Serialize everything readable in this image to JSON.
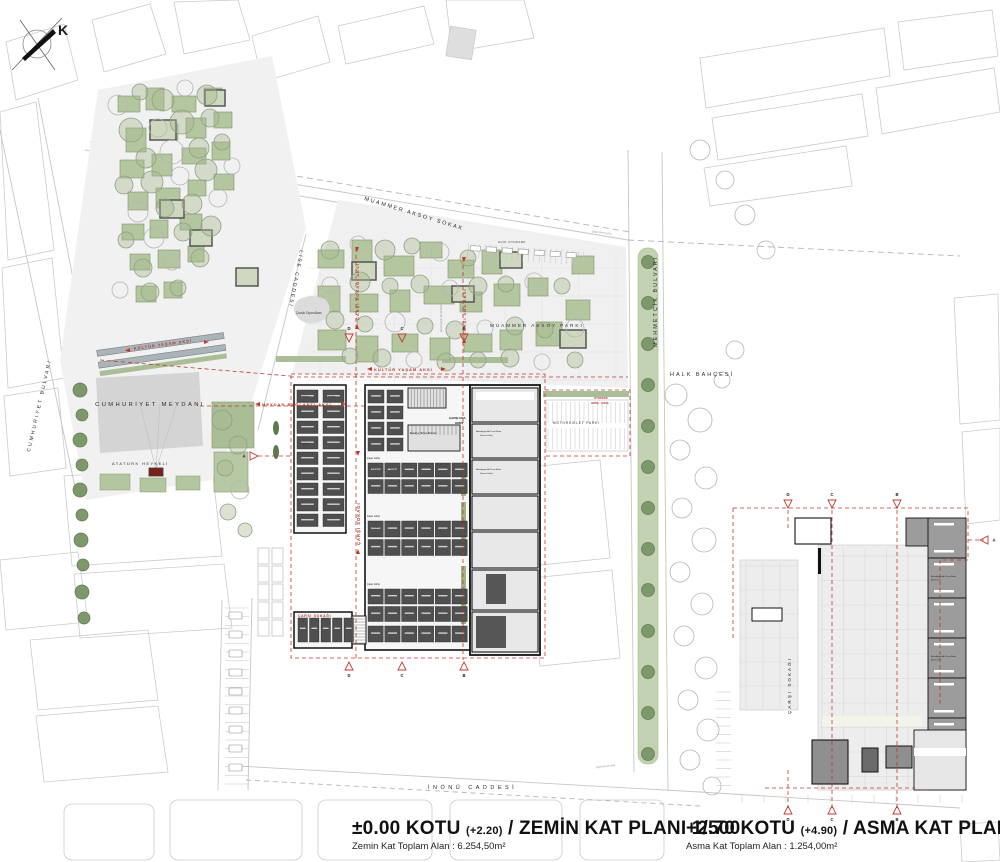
{
  "compass": {
    "letter": "K"
  },
  "streets": {
    "muammer_aksoy_sokak": "MUAMMER AKSOY SOKAK",
    "lise_caddesi": "LİSE CADDESİ",
    "cumhuriyet_bulvari": "CUMHURİYET BULVARI",
    "mehmetcik_bulvari": "MEHMETÇİK BULVARI",
    "inonu_caddesi": "İNÖNÜ CADDESİ"
  },
  "places": {
    "cumhuriyet_meydani": "CUMHURİYET MEYDANI",
    "ataturk_heykeli": "ATATÜRK HEYKELİ",
    "muammer_aksoy_parki": "MUAMMER AKSOY PARKI",
    "halk_bahcesi": "HALK BAHÇESİ",
    "motosiklet_parki": "MOTORSİKLET PARKI",
    "acik_otopark": "AÇIK OTOPARK",
    "cocuk_oyun_alani": "Çocuk Oyun Alanı",
    "gecici_acik_sergi_alani": "Geçici Açık Sergi Alanı",
    "yaya_cevre_yolu": "yaya çevre yolu",
    "carsi_sokagi_main": "ÇARŞI SOKAĞI",
    "carsi_sokagi_branch": "ÇARŞI SOKAĞI",
    "carsi_sokagi_right": "ÇARŞI SOKAĞI"
  },
  "axes": {
    "kultur_yasam_aksi": "KÜLTÜR YAŞAM AKSI",
    "meydan_baglanti_aksi": "MEYDAN BAĞLANTI AKSI",
    "carsi_sokagi_aksi": "ÇARŞI SOKAĞI AKSI",
    "carsi_ana_aksi": "ÇARŞI ANA AKSI"
  },
  "entrances": {
    "carsi_ana_giris_l1": "ÇARŞI ANA",
    "carsi_ana_giris_l2": "GİRİŞ",
    "otopark_giris_l1": "OTOPARK",
    "otopark_giris_l2": "GİRİŞ - ÇIKIŞ",
    "carsi_girisi": "Çarşı Girişi"
  },
  "units": {
    "dukkan": "Dükkan",
    "belediye_hizmet": "Belediye Hizmet Birimleri",
    "belediye_ticari_l1": "Belediyeye Ait Ticari Birim",
    "belediye_ticari_l2": "(Servis Kafe)",
    "belediye_ticari_asma_l1": "Belediyeye Ait Ticari Birim",
    "belediye_ticari_asma_l2": "Asma Kat"
  },
  "section_markers": {
    "a": "A",
    "b": "B",
    "c": "C",
    "d": "D"
  },
  "captions": {
    "zemin": {
      "kot": "±0.00 KOTU",
      "level": "(+2.20)",
      "rest": "/ ZEMİN KAT PLANI 1/500",
      "area": "Zemin Kat Toplam Alan : 6.254,50m²"
    },
    "asma": {
      "kot": "+2.70 KOTU",
      "level": "(+4.90)",
      "rest": "/ ASMA KAT PLANI 1/500",
      "area": "Asma Kat Toplam Alan : 1.254,00m²"
    }
  },
  "colors": {
    "axis_red": "#c0392b",
    "label_red": "#b03a2e",
    "plaza_gray": "#d4d4d4",
    "green_bed": "#b4c6a0",
    "unit_dark": "#4f4f4f"
  }
}
